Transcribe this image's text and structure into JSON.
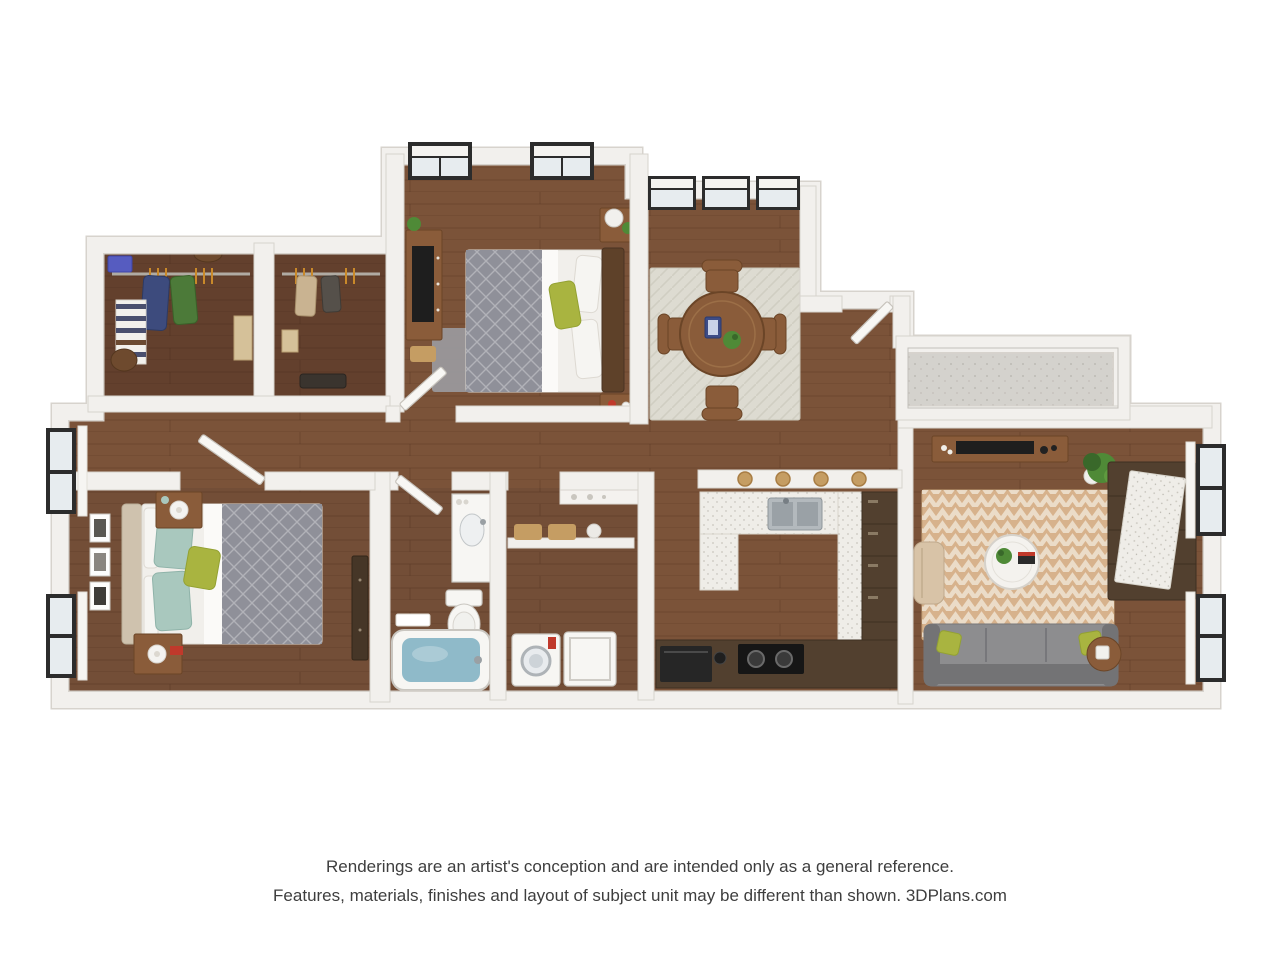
{
  "disclaimer": {
    "line1": "Renderings are an artist's conception and are intended only as a general reference.",
    "line2": "Features, materials, finishes and layout of subject unit may be different than shown. 3DPlans.com"
  },
  "colors": {
    "wall": "#f2f0ed",
    "wall-edge": "#d7d3cd",
    "wood": "#7b5339",
    "wood-dark": "#63402d",
    "wood-mid": "#734e37",
    "plank": "rgba(46,24,10,0.35)",
    "balcony": "#d4d2cd",
    "rug-dining": "#dddbd1",
    "rug-living": "#d7b28c",
    "rug-living-alt": "#eee3d2",
    "sofa": "#8d8d8f",
    "sofa-dark": "#737375",
    "accent": "#a9b440",
    "pillow-teal": "#a9c8be",
    "armchair": "#d8c3a7",
    "cabinet": "#52402f",
    "counter": "#efede8",
    "steel": "#b3b9bd",
    "appliance": "#1e1e1e",
    "water": "#8fbac9",
    "porcelain": "#f7f6f3",
    "duvet": "#8f9099",
    "sheet": "#f1efeb",
    "headboard": "#cfc2ae",
    "headboard2": "#5e4129",
    "wood-furniture": "#8a5c3a",
    "wood-furniture-dark": "#6b4527",
    "tv": "#161616",
    "plant": "#4f8a37",
    "plant-dark": "#39682a",
    "window-frame": "#2c2c2c",
    "pane": "#e7ecef",
    "curtain": "#f6f5f2",
    "door": "#f8f7f4",
    "door-edge": "#c7c3bc",
    "basket": "#c59d63",
    "navy": "#3d4b7d",
    "green-cloth": "#4c7a39",
    "box-tan": "#d5c199",
    "red": "#c0392b",
    "text": "#3e3e3e"
  }
}
